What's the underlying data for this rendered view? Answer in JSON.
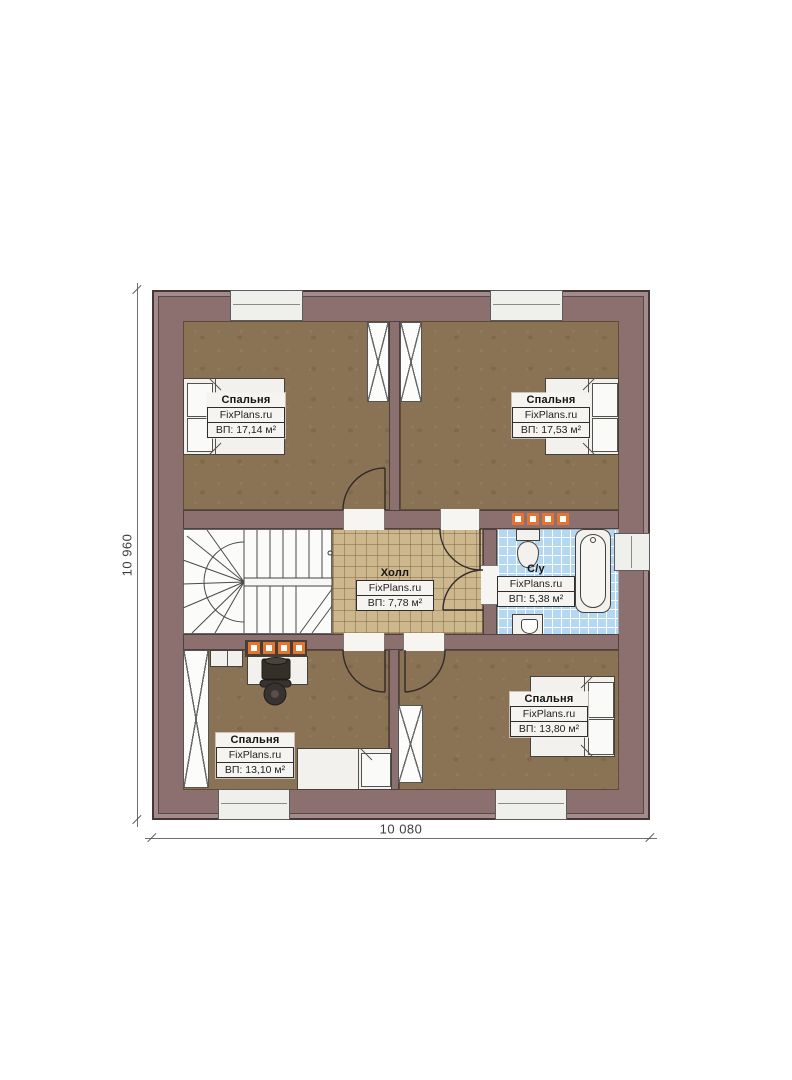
{
  "brand": "FixPlans.ru",
  "dimensions": {
    "height_label": "10 960",
    "width_label": "10 080"
  },
  "rooms": {
    "bedroom_top_left": {
      "name": "Спальня",
      "brand": "FixPlans.ru",
      "area": "ВП: 17,14 м²"
    },
    "bedroom_top_right": {
      "name": "Спальня",
      "brand": "FixPlans.ru",
      "area": "ВП: 17,53 м²"
    },
    "hall": {
      "name": "Холл",
      "brand": "FixPlans.ru",
      "area": "ВП: 7,78 м²"
    },
    "bathroom": {
      "name": "С/у",
      "brand": "FixPlans.ru",
      "area": "ВП: 5,38 м²"
    },
    "bedroom_bottom_left": {
      "name": "Спальня",
      "brand": "FixPlans.ru",
      "area": "ВП: 13,10 м²"
    },
    "bedroom_bottom_right": {
      "name": "Спальня",
      "brand": "FixPlans.ru",
      "area": "ВП: 13,80 м²"
    }
  },
  "colors": {
    "wall": "#8c7070",
    "wall_outer": "#a18b8b",
    "bedroom_floor": "#8a7254",
    "hall_tile": "#cdb78d",
    "bath_tile": "#b4d8f2",
    "vent_orange": "#e5742f"
  }
}
